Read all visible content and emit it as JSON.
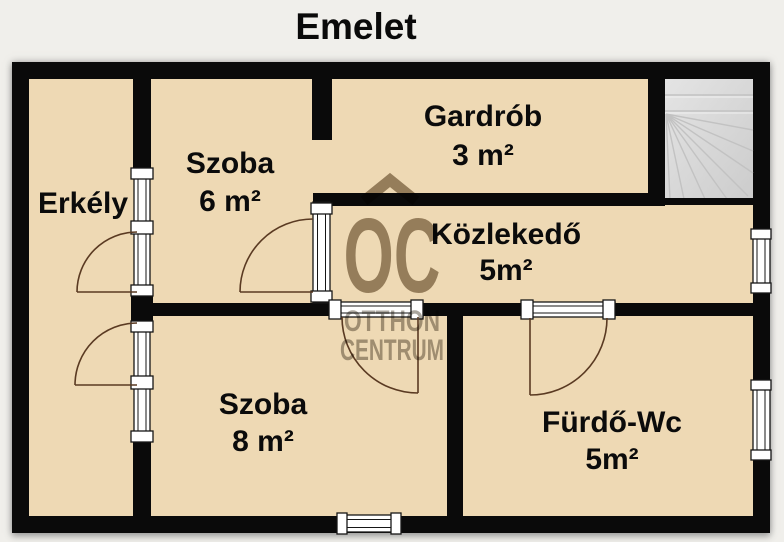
{
  "title": "Emelet",
  "rooms": [
    {
      "name": "Erkély",
      "area": ""
    },
    {
      "name": "Szoba",
      "area": "6 m²"
    },
    {
      "name": "Gardrób",
      "area": "3 m²"
    },
    {
      "name": "Közlekedő",
      "area": "5m²"
    },
    {
      "name": "Szoba",
      "area": "8 m²"
    },
    {
      "name": "Fürdő-Wc",
      "area": "5m²"
    }
  ],
  "watermark": {
    "logo": "OC",
    "line1": "OTTHON",
    "line2": "CENTRUM"
  },
  "colors": {
    "background": "#f0efeb",
    "floor": "#eed9b4",
    "wall": "#0a0a0a",
    "stairs": "#d9d9d9",
    "door_arc": "#5a3a22",
    "watermark_logo": "#9b8d79",
    "watermark_text": "#a6a199"
  }
}
